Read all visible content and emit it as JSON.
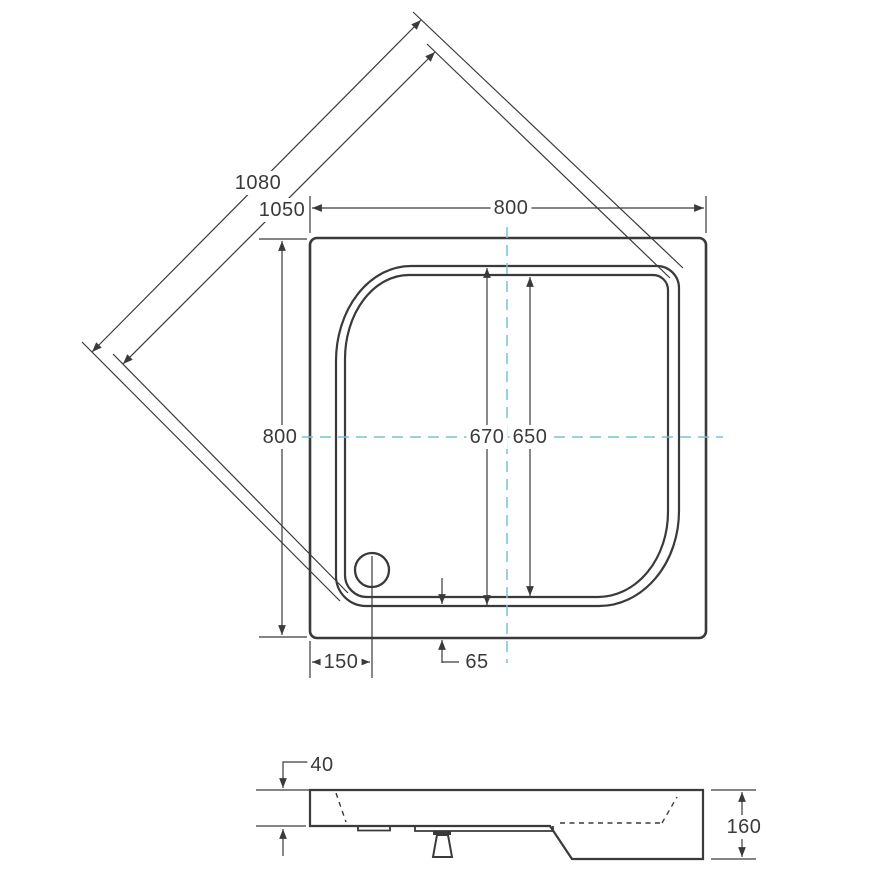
{
  "dimensions": {
    "diagonal_outer": "1080",
    "diagonal_inner": "1050",
    "top_width": "800",
    "left_height": "800",
    "basin_outer": "670",
    "basin_inner": "650",
    "drain_from_left": "150",
    "rim_to_edge": "65",
    "edge_height": "40",
    "total_height": "160"
  },
  "colors": {
    "line": "#3a3a3a",
    "centerline": "#74c6d2",
    "background": "#ffffff"
  }
}
